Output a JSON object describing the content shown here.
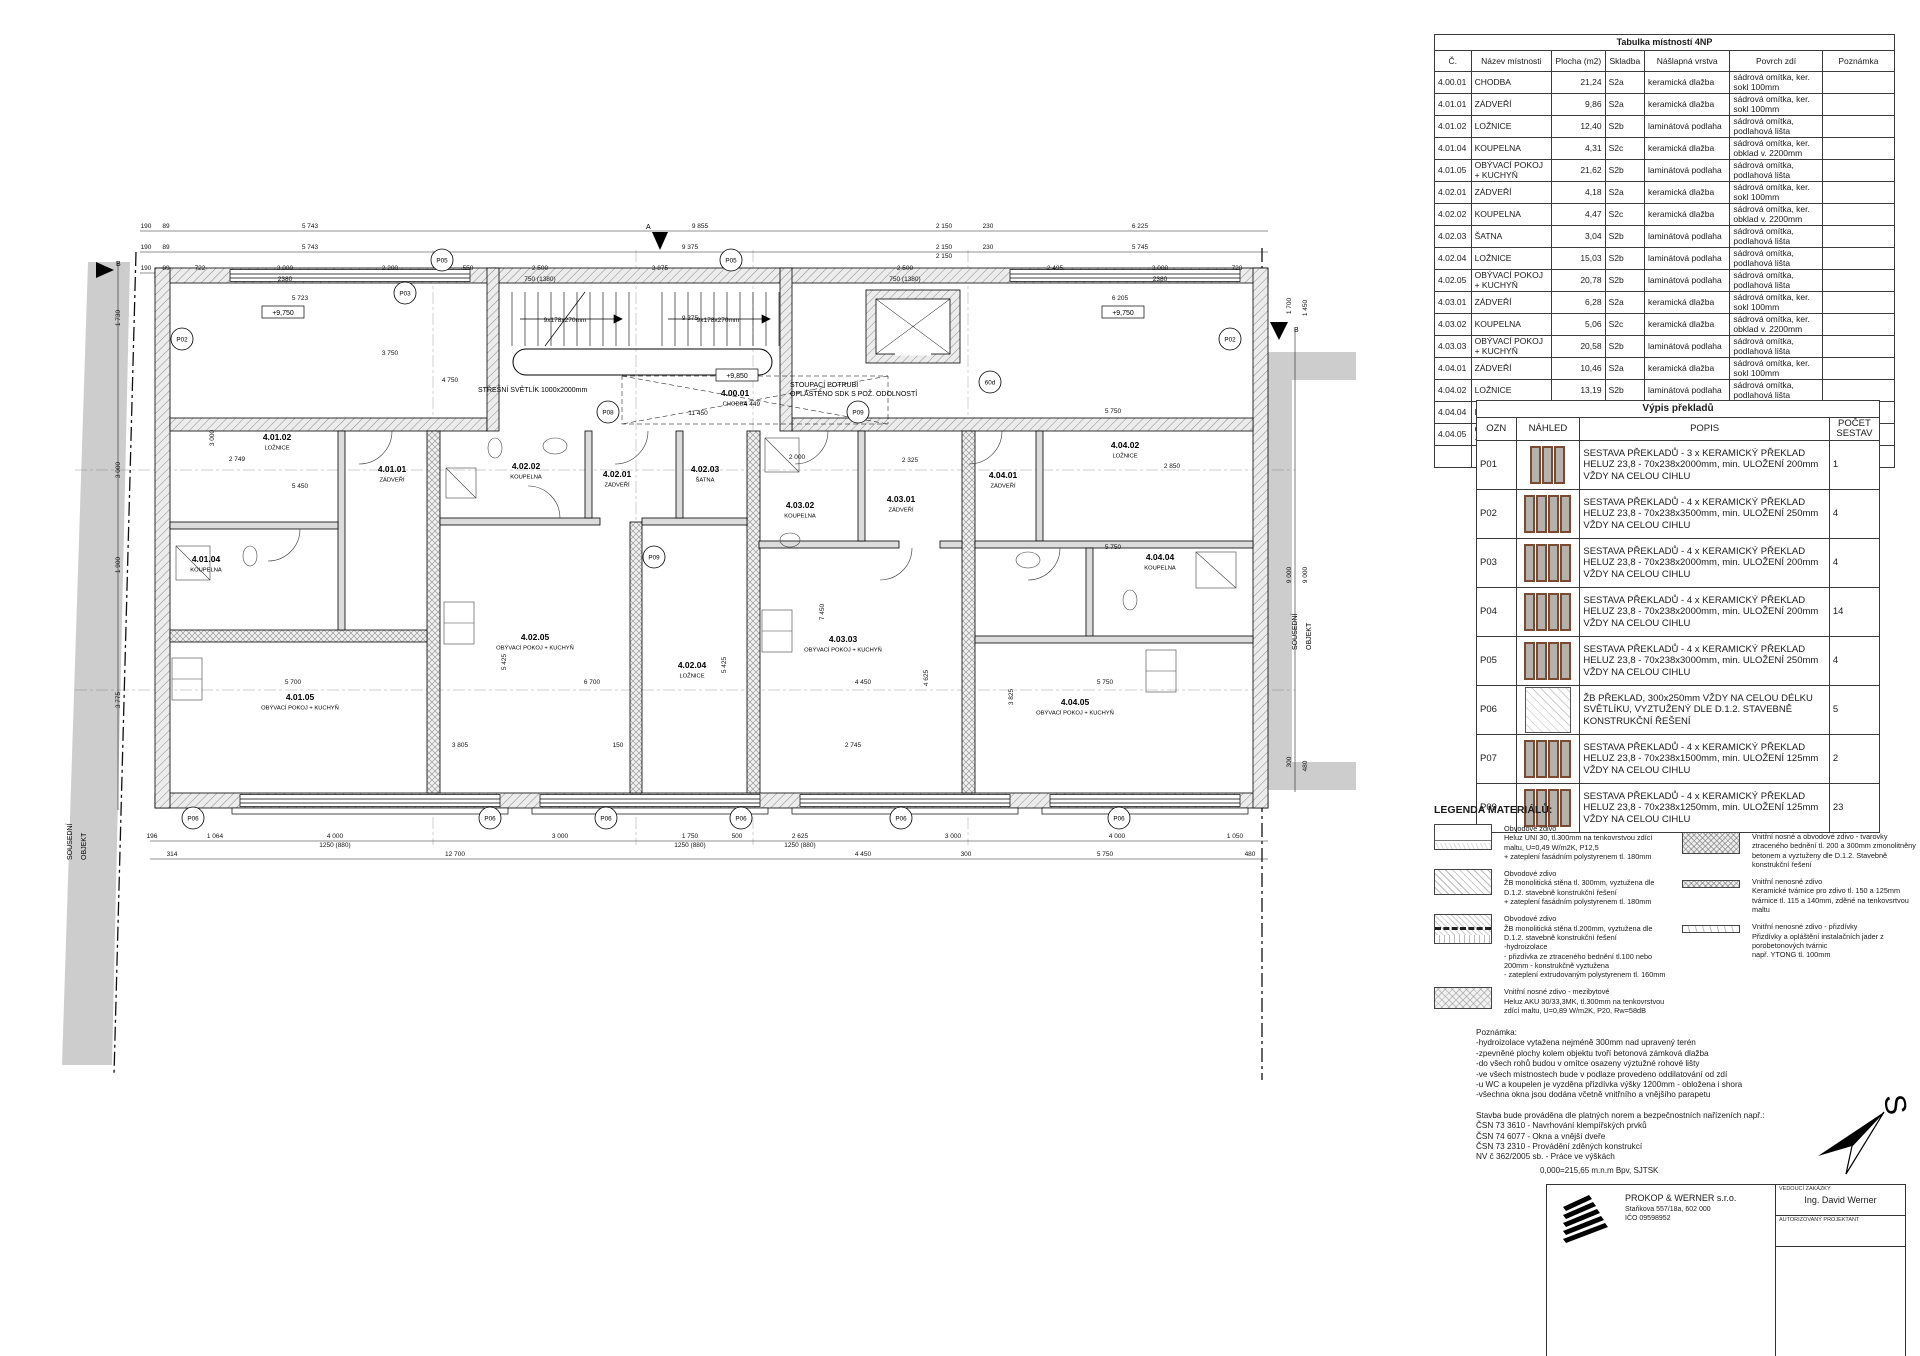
{
  "room_table": {
    "title": "Tabulka místností 4NP",
    "headers": [
      "Č.",
      "Název místnosti",
      "Plocha (m2)",
      "Skladba",
      "Nášlapná vrstva",
      "Povrch zdí",
      "Poznámka"
    ],
    "rows": [
      [
        "4.00.01",
        "CHODBA",
        "21,24",
        "S2a",
        "keramická dlažba",
        "sádrová omítka, ker. sokl 100mm",
        ""
      ],
      [
        "4.01.01",
        "ZÁDVEŘÍ",
        "9,86",
        "S2a",
        "keramická dlažba",
        "sádrová omítka, ker. sokl 100mm",
        ""
      ],
      [
        "4.01.02",
        "LOŽNICE",
        "12,40",
        "S2b",
        "laminátová podlaha",
        "sádrová omítka, podlahová lišta",
        ""
      ],
      [
        "4.01.04",
        "KOUPELNA",
        "4,31",
        "S2c",
        "keramická dlažba",
        "sádrová omítka, ker. obklad v. 2200mm",
        ""
      ],
      [
        "4.01.05",
        "OBÝVACÍ POKOJ + KUCHYŇ",
        "21,62",
        "S2b",
        "laminátová podlaha",
        "sádrová omítka, podlahová lišta",
        ""
      ],
      [
        "4.02.01",
        "ZÁDVEŘÍ",
        "4,18",
        "S2a",
        "keramická dlažba",
        "sádrová omítka, ker. sokl 100mm",
        ""
      ],
      [
        "4.02.02",
        "KOUPELNA",
        "4,47",
        "S2c",
        "keramická dlažba",
        "sádrová omítka, ker. obklad v. 2200mm",
        ""
      ],
      [
        "4.02.03",
        "ŠATNA",
        "3,04",
        "S2b",
        "laminátová podlaha",
        "sádrová omítka, podlahová lišta",
        ""
      ],
      [
        "4.02.04",
        "LOŽNICE",
        "15,03",
        "S2b",
        "laminátová podlaha",
        "sádrová omítka, podlahová lišta",
        ""
      ],
      [
        "4.02.05",
        "OBÝVACÍ POKOJ + KUCHYŇ",
        "20,78",
        "S2b",
        "laminátová podlaha",
        "sádrová omítka, podlahová lišta",
        ""
      ],
      [
        "4.03.01",
        "ZÁDVEŘÍ",
        "6,28",
        "S2a",
        "keramická dlažba",
        "sádrová omítka, ker. sokl 100mm",
        ""
      ],
      [
        "4.03.02",
        "KOUPELNA",
        "5,06",
        "S2c",
        "keramická dlažba",
        "sádrová omítka, ker. obklad v. 2200mm",
        ""
      ],
      [
        "4.03.03",
        "OBÝVACÍ POKOJ + KUCHYŇ",
        "20,58",
        "S2b",
        "laminátová podlaha",
        "sádrová omítka, podlahová lišta",
        ""
      ],
      [
        "4.04.01",
        "ZÁDVEŘÍ",
        "10,46",
        "S2a",
        "keramická dlažba",
        "sádrová omítka, ker. sokl 100mm",
        ""
      ],
      [
        "4.04.02",
        "LOŽNICE",
        "13,19",
        "S2b",
        "laminátová podlaha",
        "sádrová omítka, podlahová lišta",
        ""
      ],
      [
        "4.04.04",
        "KOUPELNA",
        "4,41",
        "S2c",
        "keramická dlažba",
        "sádrová omítka, ker. obklad v. 2200mm",
        ""
      ],
      [
        "4.04.05",
        "OBÝVACÍ POKOJ + KUCHYŇ",
        "21,99",
        "S2b",
        "laminátová podlaha",
        "sádrová omítka, podlahová lišta",
        ""
      ]
    ],
    "total": "198,90 m²"
  },
  "lintel_table": {
    "title": "Výpis překladů",
    "headers": [
      "OZN",
      "NÁHLED",
      "POPIS",
      "POČET SESTAV"
    ],
    "rows": [
      {
        "ozn": "P01",
        "thumb": "bars",
        "bars": 3,
        "popis": "SESTAVA PŘEKLADŮ  - 3 x KERAMICKÝ PŘEKLAD HELUZ 23,8 - 70x238x2000mm, min. ULOŽENÍ 200mm VŽDY NA CELOU CIHLU",
        "count": "1"
      },
      {
        "ozn": "P02",
        "thumb": "bars",
        "bars": 4,
        "popis": "SESTAVA PŘEKLADŮ  - 4 x KERAMICKÝ PŘEKLAD HELUZ 23,8 - 70x238x3500mm, min. ULOŽENÍ 250mm VŽDY NA CELOU CIHLU",
        "count": "4"
      },
      {
        "ozn": "P03",
        "thumb": "bars",
        "bars": 4,
        "popis": "SESTAVA PŘEKLADŮ  - 4 x KERAMICKÝ PŘEKLAD HELUZ 23,8 - 70x238x2000mm, min. ULOŽENÍ 200mm VŽDY NA CELOU CIHLU",
        "count": "4"
      },
      {
        "ozn": "P04",
        "thumb": "bars",
        "bars": 4,
        "popis": "SESTAVA PŘEKLADŮ  - 4 x KERAMICKÝ PŘEKLAD HELUZ 23,8 - 70x238x2000mm, min. ULOŽENÍ 200mm VŽDY NA CELOU CIHLU",
        "count": "14"
      },
      {
        "ozn": "P05",
        "thumb": "bars",
        "bars": 4,
        "popis": "SESTAVA PŘEKLADŮ  - 4 x KERAMICKÝ PŘEKLAD HELUZ 23,8 - 70x238x3000mm, min. ULOŽENÍ 250mm VŽDY NA CELOU CIHLU",
        "count": "4"
      },
      {
        "ozn": "P06",
        "thumb": "hatch",
        "bars": 0,
        "popis": "ŽB PŘEKLAD, 300x250mm VŽDY NA CELOU DÉLKU SVĚTLÍKU, VYZTUŽENÝ DLE D.1.2. STAVEBNĚ KONSTRUKČNÍ ŘEŠENÍ",
        "count": "5"
      },
      {
        "ozn": "P07",
        "thumb": "bars",
        "bars": 4,
        "popis": "SESTAVA PŘEKLADŮ  - 4 x KERAMICKÝ PŘEKLAD HELUZ 23,8 - 70x238x1500mm, min. ULOŽENÍ 125mm VŽDY NA CELOU CIHLU",
        "count": "2"
      },
      {
        "ozn": "P09",
        "thumb": "bars",
        "bars": 4,
        "popis": "SESTAVA PŘEKLADŮ  - 4 x KERAMICKÝ PŘEKLAD HELUZ 23,8 - 70x238x1250mm, min. ULOŽENÍ 125mm VŽDY NA CELOU CIHLU",
        "count": "23"
      }
    ]
  },
  "legend": {
    "title": "LEGENDA MATERIÁLŮ:",
    "col1": [
      {
        "sw": "sw-a",
        "text": "Obvodové zdivo\nHeluz UNI 30, tl.300mm na tenkovrstvou zdící\nmaltu, U=0,49 W/m2K, P12,5\n+ zateplení fasádním polystyrenem tl. 180mm"
      },
      {
        "sw": "sw-b",
        "text": "Obvodové zdivo\nŽB monolitická stěna tl. 300mm, vyztužena dle\nD.1.2. stavebně konstrukční řešení\n+ zateplení fasádním polystyrenem tl. 180mm"
      },
      {
        "sw": "sw-c",
        "text": "Obvodové zdivo\nŽB monolitická stěna tl.200mm, vyztužena dle\nD.1.2. stavebně konstrukční řešení\n-hydroizolace\n- přizdívka ze ztraceného bednění tl.100 nebo\n200mm - konstrukčně vyztužena\n- zateplení extrudovaným polystyrenem tl. 160mm"
      },
      {
        "sw": "sw-d",
        "text": "Vnitřní nosné zdivo - mezibytové\nHeluz AKU 30/33,3MK, tl.300mm na tenkovrstvou\nzdící maltu, U=0,89 W/m2K, P20, Rw=58dB"
      }
    ],
    "col2": [
      {
        "sw": "sw-e",
        "text": "Vnitřní nosné a obvodové zdivo - tvarovky\nztraceného bednění tl. 200 a 300mm zmonolitněny\nbetonem a vyztuženy dle D.1.2. Stavebně\nkonstrukční řešení"
      },
      {
        "sw": "sw-f",
        "text": "Vnitřní nenosné zdivo\nKeramické tvárnice pro zdivo tl. 150 a 125mm\ntvárnice tl. 115 a 140mm, zděné na tenkovsrtvou\nmaltu"
      },
      {
        "sw": "sw-g",
        "text": "Vnitřní nenosné zdivo - přizdívky\nPřizdívky a opláštění instalačních jader z\nporobetonových tvárnic\nnapř. YTONG tl. 100mm"
      }
    ]
  },
  "notes": {
    "title": "Poznámka:",
    "lines": [
      "-hydroizolace vytažena nejméně 300mm nad upravený terén",
      "-zpevněné plochy kolem objektu tvoří betonová zámková dlažba",
      "-do všech rohů budou v omítce osazeny výztužné rohové lišty",
      "-ve všech místnostech bude v podlaze provedeno oddilatování od zdí",
      "-u WC a koupelen je vyzděna přizdívka výšky 1200mm - obložena i shora",
      "-všechna okna jsou dodána včetně vnitřního a vnějšího parapetu"
    ],
    "norms_intro": "Stavba bude prováděna dle platných norem a bezpečnostních nařízeních např.:",
    "norms": [
      "ČSN 73 3610 - Navrhování klempířských prvků",
      "ČSN 74 6077 - Okna a vnější dveře",
      "ČSN 73 2310 - Provádění zděných konstrukcí",
      "NV č 362/2005 sb. - Práce ve výškách"
    ]
  },
  "datum_line": "0,000=215,65 m.n.m Bpv, SJTSK",
  "titleblock": {
    "company": "PROKOP & WERNER s.r.o.",
    "address": "Staňkova 557/18a, 602 000",
    "ico": "IČO 09598952",
    "role1_label": "VEDOUCÍ ZAKÁZKY",
    "role1_name": "Ing. David Werner",
    "role2_label": "AUTORIZOVANÝ PROJEKTANT"
  },
  "north_label": "S",
  "plan": {
    "neighbor_lines": [
      "SOUSEDNÍ",
      "OBJEKT"
    ],
    "stair_label": "9x178x270mm",
    "rooms": [
      {
        "id": "4.00.01",
        "name": "CHODBA",
        "x": 735,
        "y": 396
      },
      {
        "id": "4.01.01",
        "name": "ZÁDVEŘÍ",
        "x": 392,
        "y": 472
      },
      {
        "id": "4.01.02",
        "name": "LOŽNICE",
        "x": 277,
        "y": 440
      },
      {
        "id": "4.01.04",
        "name": "KOUPELNA",
        "x": 206,
        "y": 562
      },
      {
        "id": "4.01.05",
        "name": "OBÝVACÍ POKOJ + KUCHYŇ",
        "x": 300,
        "y": 700
      },
      {
        "id": "4.02.01",
        "name": "ZÁDVEŘÍ",
        "x": 617,
        "y": 477
      },
      {
        "id": "4.02.02",
        "name": "KOUPELNA",
        "x": 526,
        "y": 469
      },
      {
        "id": "4.02.03",
        "name": "ŠATNA",
        "x": 705,
        "y": 472
      },
      {
        "id": "4.02.04",
        "name": "LOŽNICE",
        "x": 692,
        "y": 668
      },
      {
        "id": "4.02.05",
        "name": "OBÝVACÍ POKOJ + KUCHYŇ",
        "x": 535,
        "y": 640
      },
      {
        "id": "4.03.01",
        "name": "ZÁDVEŘÍ",
        "x": 901,
        "y": 502
      },
      {
        "id": "4.03.02",
        "name": "KOUPELNA",
        "x": 800,
        "y": 508
      },
      {
        "id": "4.03.03",
        "name": "OBÝVACÍ POKOJ + KUCHYŇ",
        "x": 843,
        "y": 642
      },
      {
        "id": "4.04.01",
        "name": "ZÁDVEŘÍ",
        "x": 1003,
        "y": 478
      },
      {
        "id": "4.04.02",
        "name": "LOŽNICE",
        "x": 1125,
        "y": 448
      },
      {
        "id": "4.04.04",
        "name": "KOUPELNA",
        "x": 1160,
        "y": 560
      },
      {
        "id": "4.04.05",
        "name": "OBÝVACÍ POKOJ + KUCHYŇ",
        "x": 1075,
        "y": 705
      }
    ],
    "texts": [
      {
        "t": "STŘEŠNÍ SVĚTLÍK 1000x2000mm",
        "x": 478,
        "y": 392,
        "a": "start"
      },
      {
        "t": "STOUPACÍ POTRUBÍ",
        "x": 790,
        "y": 387,
        "a": "start"
      },
      {
        "t": "OPLÁŠTĚNO SDK S POŽ. ODOLNOSTÍ",
        "x": 790,
        "y": 396,
        "a": "start"
      },
      {
        "t": "B",
        "x": 116,
        "y": 266,
        "a": "start"
      },
      {
        "t": "B",
        "x": 1294,
        "y": 332,
        "a": "start"
      },
      {
        "t": "A",
        "x": 646,
        "y": 229,
        "a": "start"
      }
    ],
    "boxes": [
      {
        "t": "+9,750",
        "x": 283,
        "y": 315
      },
      {
        "t": "+9,750",
        "x": 1123,
        "y": 315
      },
      {
        "t": "+9,850",
        "x": 737,
        "y": 378
      }
    ],
    "markers": [
      {
        "t": "P02",
        "x": 182,
        "y": 339
      },
      {
        "t": "P03",
        "x": 405,
        "y": 293
      },
      {
        "t": "P05",
        "x": 442,
        "y": 260
      },
      {
        "t": "P05",
        "x": 731,
        "y": 260
      },
      {
        "t": "P08",
        "x": 608,
        "y": 412
      },
      {
        "t": "P09",
        "x": 654,
        "y": 557
      },
      {
        "t": "P09",
        "x": 858,
        "y": 412
      },
      {
        "t": "60d",
        "x": 990,
        "y": 382
      },
      {
        "t": "P02",
        "x": 1230,
        "y": 339
      },
      {
        "t": "P06",
        "x": 193,
        "y": 818
      },
      {
        "t": "P06",
        "x": 490,
        "y": 818
      },
      {
        "t": "P06",
        "x": 606,
        "y": 818
      },
      {
        "t": "P06",
        "x": 741,
        "y": 818
      },
      {
        "t": "P06",
        "x": 901,
        "y": 818
      },
      {
        "t": "P06",
        "x": 1119,
        "y": 818
      }
    ],
    "dims": [
      {
        "t": "190",
        "x": 146,
        "y": 228
      },
      {
        "t": "89",
        "x": 166,
        "y": 228
      },
      {
        "t": "5 743",
        "x": 310,
        "y": 228
      },
      {
        "t": "9 855",
        "x": 700,
        "y": 228
      },
      {
        "t": "2 150",
        "x": 944,
        "y": 228
      },
      {
        "t": "230",
        "x": 988,
        "y": 228
      },
      {
        "t": "6 225",
        "x": 1140,
        "y": 228
      },
      {
        "t": "190",
        "x": 146,
        "y": 249
      },
      {
        "t": "89",
        "x": 166,
        "y": 249
      },
      {
        "t": "5 743",
        "x": 310,
        "y": 249
      },
      {
        "t": "9 375",
        "x": 690,
        "y": 249
      },
      {
        "t": "2 150",
        "x": 944,
        "y": 249
      },
      {
        "t": "230",
        "x": 988,
        "y": 249
      },
      {
        "t": "5 745",
        "x": 1140,
        "y": 249
      },
      {
        "t": "190",
        "x": 146,
        "y": 270
      },
      {
        "t": "89",
        "x": 166,
        "y": 270
      },
      {
        "t": "722",
        "x": 200,
        "y": 270
      },
      {
        "t": "3 000",
        "x": 285,
        "y": 270
      },
      {
        "t": "2380",
        "x": 285,
        "y": 281
      },
      {
        "t": "2 200",
        "x": 390,
        "y": 270
      },
      {
        "t": "550",
        "x": 468,
        "y": 270
      },
      {
        "t": "2 500",
        "x": 540,
        "y": 270
      },
      {
        "t": "750 (1380)",
        "x": 540,
        "y": 281
      },
      {
        "t": "3 875",
        "x": 660,
        "y": 270
      },
      {
        "t": "2 500",
        "x": 905,
        "y": 270
      },
      {
        "t": "750 (1380)",
        "x": 905,
        "y": 281
      },
      {
        "t": "2 150",
        "x": 944,
        "y": 258
      },
      {
        "t": "2 495",
        "x": 1055,
        "y": 270
      },
      {
        "t": "3 000",
        "x": 1160,
        "y": 270
      },
      {
        "t": "2380",
        "x": 1160,
        "y": 281
      },
      {
        "t": "720",
        "x": 1237,
        "y": 270
      },
      {
        "t": "1 064",
        "x": 215,
        "y": 838
      },
      {
        "t": "4 000",
        "x": 335,
        "y": 838
      },
      {
        "t": "1250 (880)",
        "x": 335,
        "y": 847
      },
      {
        "t": "3 000",
        "x": 560,
        "y": 838
      },
      {
        "t": "1 750",
        "x": 690,
        "y": 838
      },
      {
        "t": "1250 (880)",
        "x": 690,
        "y": 847
      },
      {
        "t": "500",
        "x": 737,
        "y": 838
      },
      {
        "t": "2 625",
        "x": 800,
        "y": 838
      },
      {
        "t": "1250 (880)",
        "x": 800,
        "y": 847
      },
      {
        "t": "3 000",
        "x": 953,
        "y": 838
      },
      {
        "t": "4 000",
        "x": 1117,
        "y": 838
      },
      {
        "t": "1 050",
        "x": 1235,
        "y": 838
      },
      {
        "t": "196",
        "x": 152,
        "y": 838
      },
      {
        "t": "314",
        "x": 172,
        "y": 856
      },
      {
        "t": "12 700",
        "x": 455,
        "y": 856
      },
      {
        "t": "4 450",
        "x": 863,
        "y": 856
      },
      {
        "t": "300",
        "x": 966,
        "y": 856
      },
      {
        "t": "5 750",
        "x": 1105,
        "y": 856
      },
      {
        "t": "480",
        "x": 1250,
        "y": 856
      },
      {
        "t": "1 730",
        "x": 120,
        "y": 318,
        "r": 1
      },
      {
        "t": "3 000",
        "x": 120,
        "y": 470,
        "r": 1
      },
      {
        "t": "1 900",
        "x": 120,
        "y": 565,
        "r": 1
      },
      {
        "t": "3 775",
        "x": 120,
        "y": 700,
        "r": 1
      },
      {
        "t": "1 700",
        "x": 1291,
        "y": 306,
        "r": 1
      },
      {
        "t": "1 450",
        "x": 1307,
        "y": 308,
        "r": 1
      },
      {
        "t": "9 000",
        "x": 1291,
        "y": 575,
        "r": 1
      },
      {
        "t": "9 000",
        "x": 1307,
        "y": 575,
        "r": 1
      },
      {
        "t": "300",
        "x": 1291,
        "y": 762,
        "r": 1
      },
      {
        "t": "480",
        "x": 1307,
        "y": 766,
        "r": 1
      },
      {
        "t": "5 723",
        "x": 300,
        "y": 300
      },
      {
        "t": "6 205",
        "x": 1120,
        "y": 300
      },
      {
        "t": "5 450",
        "x": 300,
        "y": 488
      },
      {
        "t": "2 749",
        "x": 237,
        "y": 461
      },
      {
        "t": "2 000",
        "x": 797,
        "y": 459
      },
      {
        "t": "2 325",
        "x": 910,
        "y": 462
      },
      {
        "t": "5 750",
        "x": 1113,
        "y": 413
      },
      {
        "t": "5 750",
        "x": 1113,
        "y": 549
      },
      {
        "t": "2 850",
        "x": 1172,
        "y": 468
      },
      {
        "t": "4 449",
        "x": 752,
        "y": 406
      },
      {
        "t": "11 450",
        "x": 698,
        "y": 415
      },
      {
        "t": "5 700",
        "x": 293,
        "y": 684
      },
      {
        "t": "6 700",
        "x": 592,
        "y": 684
      },
      {
        "t": "4 450",
        "x": 863,
        "y": 684
      },
      {
        "t": "5 750",
        "x": 1105,
        "y": 684
      },
      {
        "t": "3 805",
        "x": 460,
        "y": 747
      },
      {
        "t": "2 745",
        "x": 853,
        "y": 747
      },
      {
        "t": "150",
        "x": 618,
        "y": 747
      },
      {
        "t": "7 450",
        "x": 824,
        "y": 612,
        "r": 1
      },
      {
        "t": "3 825",
        "x": 1013,
        "y": 697,
        "r": 1
      },
      {
        "t": "4 625",
        "x": 928,
        "y": 678,
        "r": 1
      },
      {
        "t": "5 425",
        "x": 506,
        "y": 662,
        "r": 1
      },
      {
        "t": "5 425",
        "x": 726,
        "y": 665,
        "r": 1
      },
      {
        "t": "3 000",
        "x": 214,
        "y": 438,
        "r": 1
      },
      {
        "t": "9 375",
        "x": 690,
        "y": 320
      },
      {
        "t": "3 750",
        "x": 390,
        "y": 355
      },
      {
        "t": "4 750",
        "x": 450,
        "y": 382
      }
    ]
  }
}
